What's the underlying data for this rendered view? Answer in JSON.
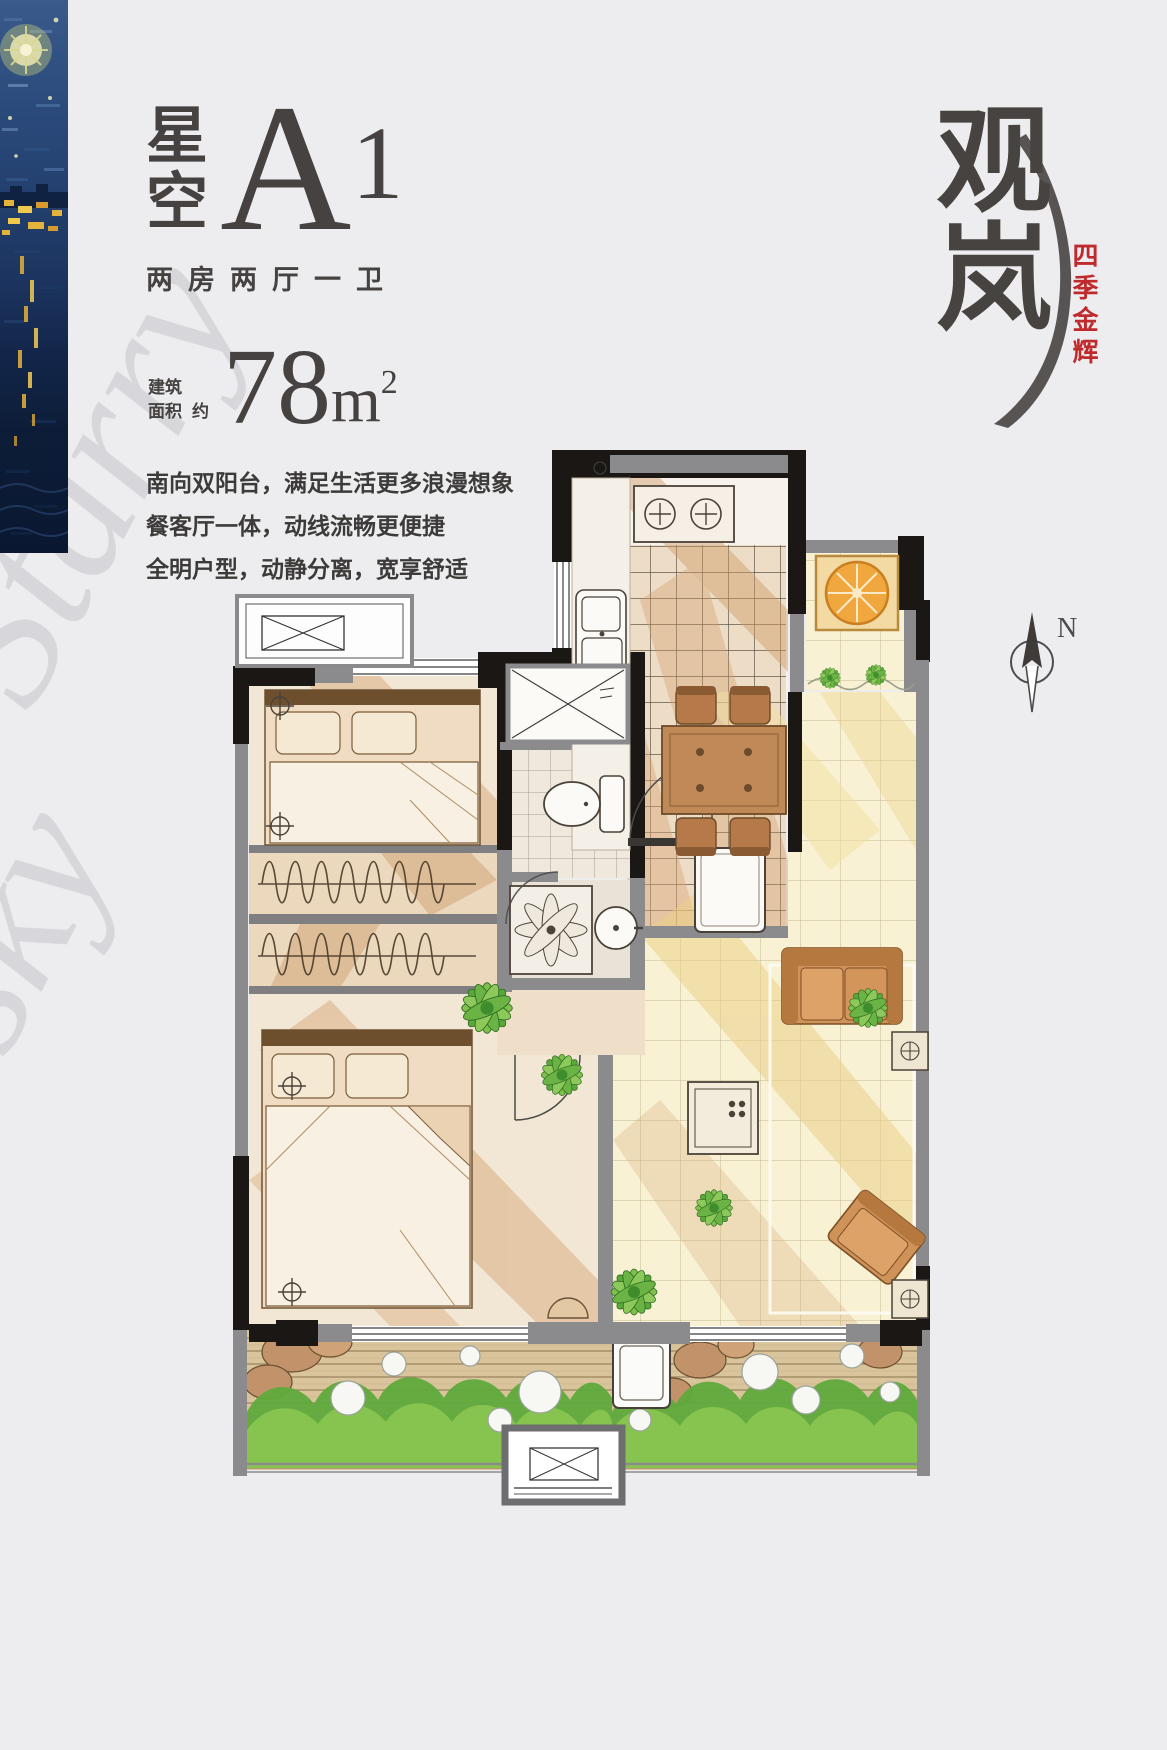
{
  "colors": {
    "background": "#ededef",
    "ink": "#454241",
    "accent_red": "#bf2b2c",
    "watermark_gray": "#c9c9ce",
    "wall_black": "#1a1714",
    "wall_gray": "#7f7f81",
    "bedroom_tan": "#f2e6d4",
    "living_yellow": "#f8f1d3",
    "plant_green": "#6fb544",
    "wood_deck": "#d9c49c"
  },
  "header": {
    "title_cn_top": "星",
    "title_cn_bottom": "空",
    "title_type": "A",
    "title_index": "1",
    "layout_text": "两房两厅一卫"
  },
  "area": {
    "label_top": "建筑",
    "label_bottom": "面积",
    "approx": "约",
    "value": "78",
    "unit": "m",
    "superscript": "2"
  },
  "description": {
    "lines": [
      "南向双阳台，满足生活更多浪漫想象",
      "餐客厅一体，动线流畅更便捷",
      "全明户型，动静分离，宽享舒适"
    ]
  },
  "brand": {
    "logo_top": "观",
    "logo_bottom": "岚",
    "sub_vertical": "四季金辉"
  },
  "compass": {
    "north_label": "N"
  },
  "watermark": {
    "word1": "Starry",
    "word2": "sky"
  }
}
